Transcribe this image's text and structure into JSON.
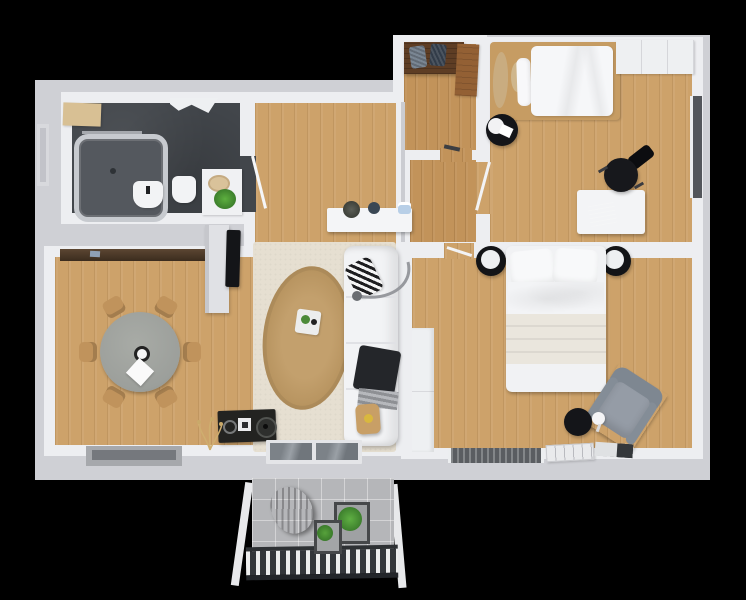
{
  "scene": {
    "type": "3d-floor-plan-render",
    "view": "top-down",
    "visible_text": [],
    "background": "black"
  },
  "colors": {
    "background": "#000000",
    "wall_outer": "#cfd0d5",
    "wall_face": "#edeef1",
    "wood_base": "#cda26a",
    "wood_dark": "#c2935a",
    "bath_floor": "#42464b",
    "rug_beige": "#e6dfd1",
    "rug_jute": "#c3a06d",
    "sofa": "#f2f3f5",
    "dining_table": "#9c9f9b",
    "chair_wood": "#c0935c",
    "shelf_brown": "#4c3827",
    "wardrobe_brown": "#5e3d24",
    "wardrobe_brown_light": "#936034",
    "furniture_black": "#1a1b1e",
    "armchair_gray": "#959ca6",
    "balcony_floor": "#b5b6b9",
    "railing_dark": "#33363a",
    "plant_green": "#4c8a38",
    "glass": "#6b7076",
    "window_dark": "#53565b",
    "laptop_blue": "#2d3f5c",
    "accent_yellow": "#d9b83e",
    "cup_blue": "#b8cfe7",
    "blanket_cream": "#eae6dd",
    "radiator_gray": "#5a5d61",
    "mat_tan": "#d8c094"
  },
  "rooms": [
    {
      "id": "bathroom",
      "furniture": [
        "bathtub",
        "towel-rail",
        "bath-mat",
        "hanging-towels",
        "toilet",
        "bidet",
        "vanity",
        "vanity-basin",
        "vanity-plant",
        "window"
      ]
    },
    {
      "id": "entry",
      "furniture": [
        "wardrobe",
        "folded-coats",
        "open-wardrobe-door",
        "door-mark"
      ]
    },
    {
      "id": "hallway",
      "furniture": [
        "console-table",
        "decor-pot",
        "decor-vase",
        "decor-cup"
      ]
    },
    {
      "id": "bedroom-1",
      "furniture": [
        "double-bed",
        "decor-pillows",
        "pouf-with-tray",
        "desk",
        "laptop",
        "office-chair",
        "wardrobe",
        "window",
        "door"
      ]
    },
    {
      "id": "bedroom-2",
      "furniture": [
        "double-bed",
        "nightstand-left",
        "nightstand-right",
        "armchair",
        "side-table",
        "reading-lamp",
        "wardrobe",
        "magazines",
        "radiator",
        "door"
      ]
    },
    {
      "id": "living-room",
      "furniture": [
        "sofa",
        "zebra-pillow",
        "throw-blanket",
        "arc-lamp",
        "area-rug",
        "jute-rug",
        "tray",
        "side-stool",
        "media-cabinet",
        "dried-plant",
        "tv",
        "tv-partition",
        "balcony-door"
      ]
    },
    {
      "id": "dining-area",
      "furniture": [
        "round-table",
        "dining-chairs",
        "wall-shelf",
        "window"
      ]
    },
    {
      "id": "balcony",
      "furniture": [
        "hanging-chair",
        "planter-large",
        "planter-small",
        "railing",
        "posts"
      ]
    }
  ]
}
